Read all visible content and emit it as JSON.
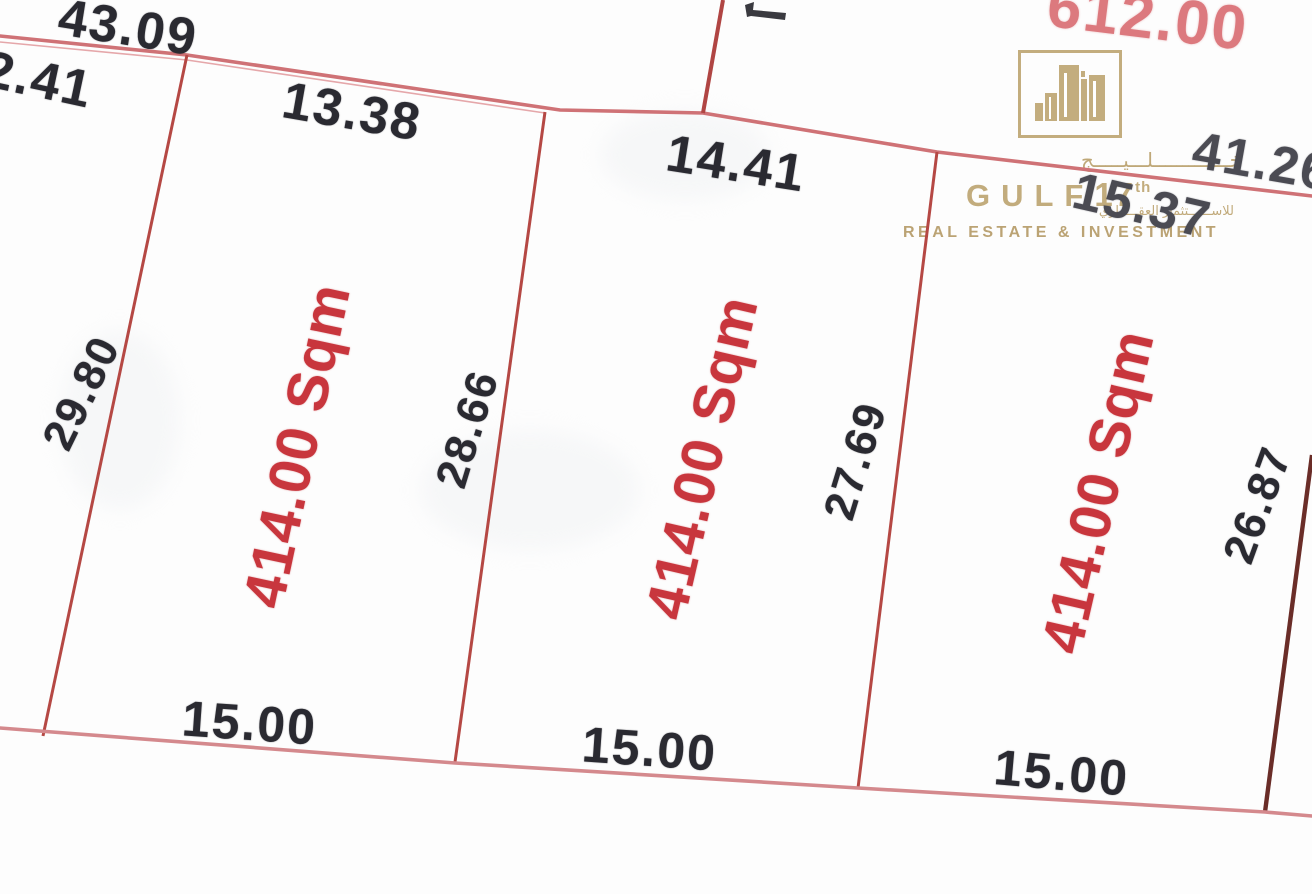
{
  "watermark": {
    "brand_arabic": "خـــــــــــــلـــيـــــج",
    "brand_en": "GULF",
    "brand_number": "17",
    "brand_number_suffix": "th",
    "tagline_arabic": "للاســــــتثمار العقـــــاري",
    "tagline_en": "REAL ESTATE & INVESTMENT",
    "gold_color": "#c2ab7c"
  },
  "plots": {
    "plot1_area": "414.00 Sqm",
    "plot2_area": "414.00 Sqm",
    "plot3_area": "414.00 Sqm",
    "upper_plot_area_partial": "612.00"
  },
  "dimensions": {
    "top_outer_left": "43.09",
    "left_edge_partial": "2.41",
    "plot1_top": "13.38",
    "plot2_top": "14.41",
    "plot3_top": "15.37",
    "top_outer_right": "41.26",
    "plot1_left": "29.80",
    "plot1_right": "28.66",
    "plot2_right": "27.69",
    "plot3_right": "26.87",
    "plot1_bottom": "15.00",
    "plot2_bottom": "15.00",
    "plot3_bottom": "15.00"
  },
  "colors": {
    "boundary_pink": "#d4898d",
    "divider_red": "#b54844",
    "divider_dark_maroon": "#6a2d28",
    "area_text_red": "#c8363d",
    "dimension_text": "#2a2a31",
    "logo_gold": "#c2ab7c"
  }
}
